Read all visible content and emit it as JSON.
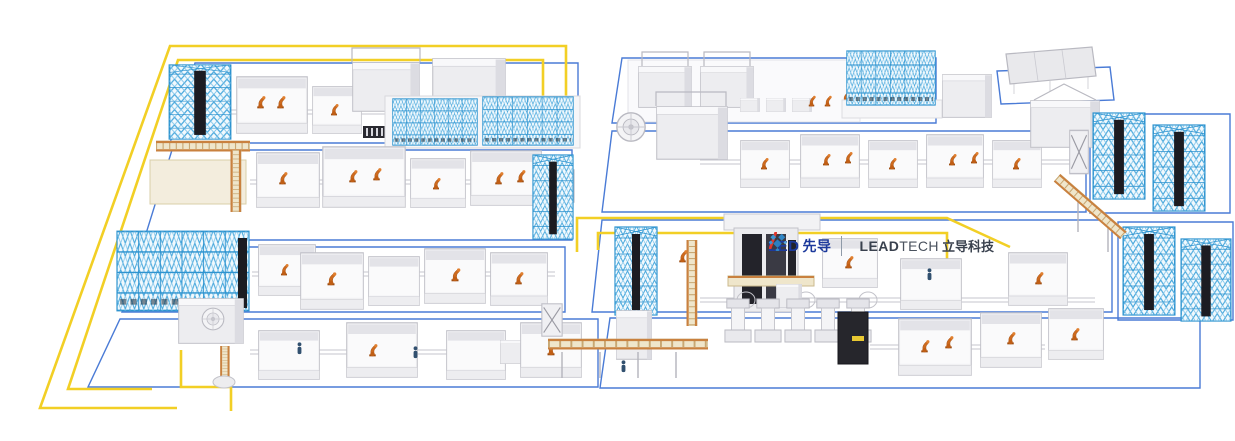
{
  "brand": {
    "logo_left": {
      "pre": "LE",
      "post": "D",
      "cn": "先导",
      "full": "LEAD先导"
    },
    "logo_right": {
      "bold": "LEAD",
      "regular": "TECH",
      "cn": "立导科技",
      "full": "LEADTECH立导科技"
    },
    "icon": "diamond-cluster-icon"
  },
  "colors": {
    "background": "#FFFFFF",
    "cable_yellow": "#F2CF25",
    "floor_outline_blue": "#4A7BD6",
    "rack_cyan": "#2E93CF",
    "robot_orange": "#CE6A1E",
    "conveyor_tan": "#EFE6CB",
    "conveyor_rail_orange": "#C9813F",
    "machine_gray": "#F2F2F4",
    "machine_edge_gray": "#C2C2C9",
    "tower_black": "#1C1C22",
    "logo_navy": "#1D3A9C",
    "logo_red": "#E2362B",
    "logo_text_dark": "#39414E"
  }
}
